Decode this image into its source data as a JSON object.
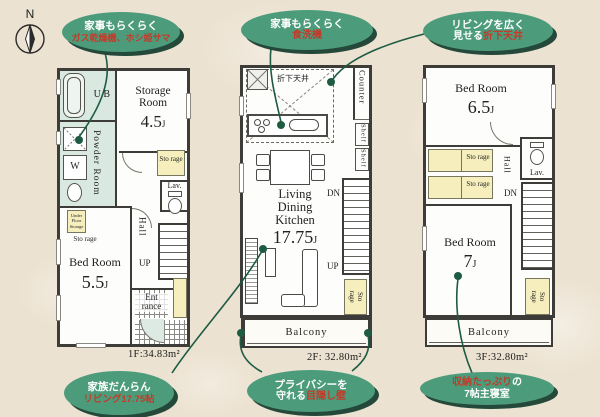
{
  "compass": {
    "label": "N"
  },
  "unit_j": "J",
  "callouts": {
    "gas_dryer": {
      "line1": "家事もらくらく",
      "line2_red": "ガス乾燥機、ホシ姫サマ"
    },
    "dishwasher": {
      "line1": "家事もらくらく",
      "line2_red": "食洗機"
    },
    "folded_ceiling": {
      "line1": "リビングを広く",
      "line2_white": "見せる",
      "line2_red": "折下天井"
    },
    "family_living": {
      "line1": "家族だんらん",
      "line2_red": "リビング17.75帖"
    },
    "privacy_wall": {
      "line1": "プライバシーを",
      "line2_white": "守れる",
      "line2_red": "目隠し壁"
    },
    "main_bedroom": {
      "line1_red": "収納たっぷり",
      "line1_white": "の",
      "line2": "7帖主寝室"
    }
  },
  "floor1": {
    "area_label": "1F:34.83m²",
    "ub": "U B",
    "storage_room_name": "Storage Room",
    "storage_room_size": "4.5",
    "powder_room": "Powder Room",
    "washer": "W",
    "storage_small": "Sto rage",
    "lav": "Lav.",
    "under_floor_storage": "Under Floor Storage",
    "storage_under_label": "Sto rage",
    "hall": "Hall",
    "up": "UP",
    "bedroom_name": "Bed Room",
    "bedroom_size": "5.5",
    "entrance": "Ent rance"
  },
  "floor2": {
    "area_label": "2F: 32.80m²",
    "folded_ceiling": "折下天井",
    "counter": "Counter",
    "shelf": "Shelf",
    "ldk_name": "Living Dining Kitchen",
    "ldk_size": "17.75",
    "dn": "DN",
    "up": "UP",
    "storage_small": "Sto rage",
    "balcony": "Balcony"
  },
  "floor3": {
    "area_label": "3F:32.80m²",
    "bedroom1_name": "Bed Room",
    "bedroom1_size": "6.5",
    "storage_small": "Sto rage",
    "hall": "Hall",
    "lav": "Lav.",
    "dn": "DN",
    "bedroom2_name": "Bed Room",
    "bedroom2_size": "7",
    "balcony": "Balcony"
  },
  "colors": {
    "background": "#ece2d1",
    "callout_green": "#4c9c7c",
    "callout_shadow": "#24483a",
    "callout_red_text": "#c23b29",
    "leader_green": "#1e5b43",
    "wet_area": "#d9e8e1",
    "storage_yellow": "#f6efbd",
    "wall": "#3e3c38"
  }
}
